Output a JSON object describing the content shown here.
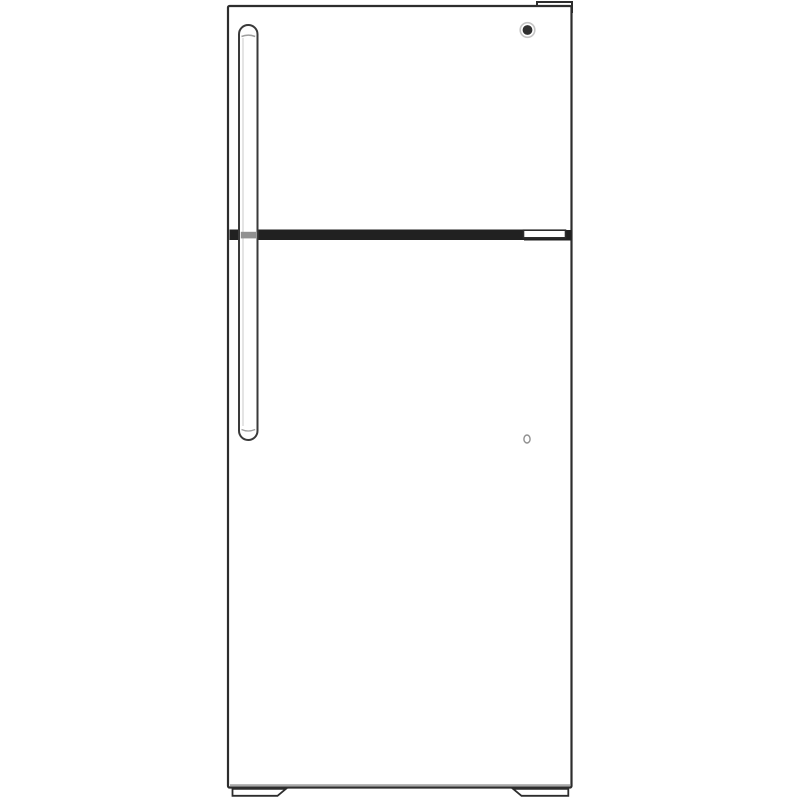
{
  "page": {
    "background": "#ffffff"
  },
  "product_image": {
    "alt": "Front-view line drawing of a white top-freezer refrigerator",
    "colors": {
      "outline": "#2d2d2d",
      "body_fill": "#ffffff",
      "divider_band": "#212121",
      "handle_outline": "#3a3a3a",
      "handle_inner_detail": "#9f9f9f",
      "handle_band_stripe": "#909090",
      "handle_highlight": "#c9c9c9",
      "badge_core": "#303030",
      "badge_ring": "#c5c5c5",
      "lock_outline": "#909090",
      "bottom_shadow": "#a8a8a8"
    },
    "parts": {
      "cabinet": "refrigerator cabinet",
      "freezer_door": "freezer door (top)",
      "fridge_door": "fresh-food door (bottom)",
      "divider": "door divider trim band",
      "divider_end_cap": "divider hinge end cap",
      "door_handle": "vertical door handle",
      "brand_badge": "round brand logo badge",
      "hinge_cover": "top hinge cover",
      "lock": "small door keyhole",
      "left_foot": "left leveling foot",
      "right_foot": "right leveling foot"
    }
  }
}
